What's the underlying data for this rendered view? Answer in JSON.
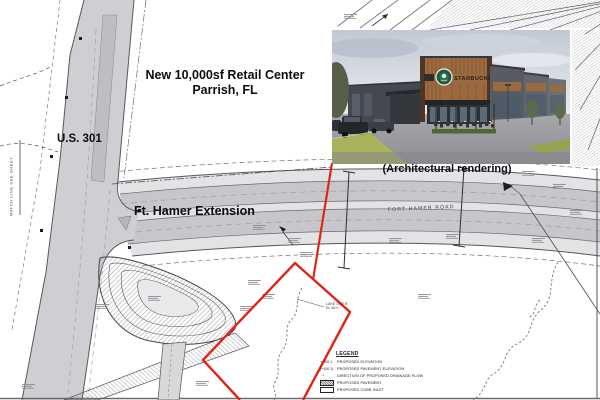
{
  "plan": {
    "labels": {
      "project_line1": "New 10,000sf Retail Center",
      "project_line2": "Parrish, FL",
      "us_301": "U.S. 301",
      "ft_hamer": "Ft. Hamer Extension",
      "road_centerline": "FORT HAMER ROAD",
      "matchline": "MATCH LINE SEE SHEET",
      "lake_name": "LAKE ONE B",
      "lake_elev": "EL 46.0"
    },
    "legend": {
      "title": "LEGEND",
      "items": [
        {
          "symbol_type": "text",
          "symbol_text": "+ 100.1",
          "label": "PROPOSED ELEVATION"
        },
        {
          "symbol_type": "text",
          "symbol_text": "(+100.1)",
          "label": "PROPOSED PAVEMENT ELEVATION"
        },
        {
          "symbol_type": "arrow",
          "symbol_text": "→",
          "label": "DIRECTION OF PROPOSED DRAINAGE FLOW"
        },
        {
          "symbol_type": "hatch_box",
          "symbol_text": "",
          "label": "PROPOSED PAVEMENT"
        },
        {
          "symbol_type": "open_box",
          "symbol_text": "",
          "label": "PROPOSED CURB INLET"
        }
      ]
    },
    "colors": {
      "parcel_red": "#e02418",
      "road_fill": "#cfcfd3",
      "linework": "#3f3f44"
    }
  },
  "inset": {
    "caption": "(Architectural rendering)",
    "sign_text": "STARBUCKS",
    "logo_icon": "starbucks-siren-logo"
  }
}
